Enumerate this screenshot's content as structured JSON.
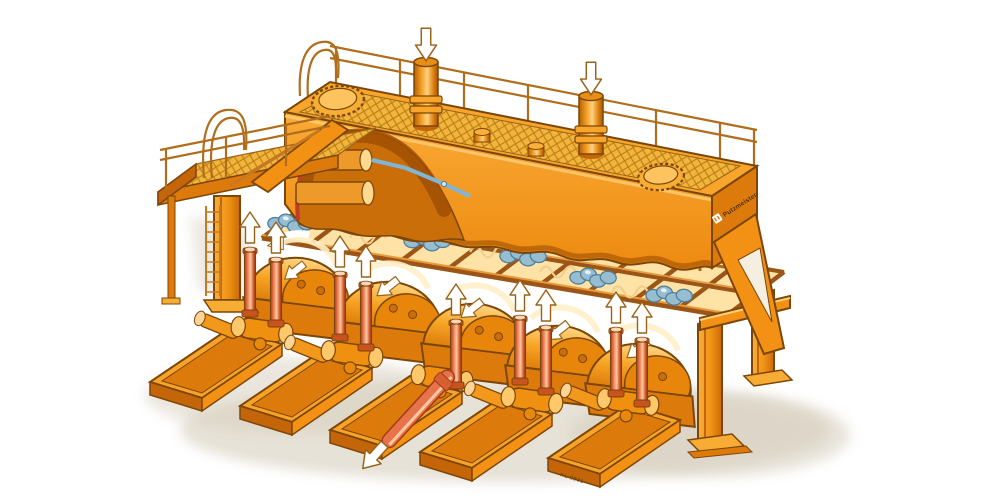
{
  "figure": {
    "type": "technical-cutaway-illustration",
    "description": "Isometric cutaway illustration of an orange five-cylinder piston pump station with suction tank, access platform, valve deck and flow arrows"
  },
  "branding": {
    "logo_text": "Putzmeister"
  },
  "annotations": {
    "drawing_number": "KL 0931"
  },
  "flow_arrows": {
    "inlet_down_arrows": 2,
    "outlet_up_arrows": 9,
    "housing_arrows": 6,
    "drain_diagonal_arrows": 1
  },
  "components": {
    "suction_tank": {
      "manhole_covers": 2,
      "inlet_pipes": 2,
      "walkway_grating": true,
      "perimeter_railing": true
    },
    "access_platform": {
      "railing_loops": 2,
      "ladder": true,
      "grating": true
    },
    "valve_deck": {
      "valve_banks": 7,
      "spring_coils": 4,
      "cross_bars": 11
    },
    "pump_units": {
      "count": 5,
      "dampener_cylinders": 9,
      "crank_housings": 5,
      "skid_bases": 5,
      "drain_pipe": 1
    },
    "support_legs": 4
  },
  "palette": {
    "orange_top": "#F8A62B",
    "orange_mid": "#F29114",
    "orange_deep": "#DD7A0C",
    "orange_shade": "#C36508",
    "orange_dark": "#A85405",
    "cream": "#FFE3A6",
    "cream_bright": "#FFF0C8",
    "grating_fill": "#F1B43C",
    "grating_line": "#BC7D12",
    "outline": "#7C4608",
    "outline_soft": "#9A6218",
    "salmon": "#E8734A",
    "salmon_light": "#FFC9A0",
    "salmon_dark": "#A03C1B",
    "steel_blue": "#97BDD0",
    "steel_blue_light": "#E3F2F8",
    "steel_blue_dark": "#4F7F9B",
    "pipe_blue": "#7FB5D6",
    "cut_red": "#C23A28",
    "interior": "#C96E08",
    "shadow": "#CFC5B0",
    "white": "#FFFFFF"
  }
}
